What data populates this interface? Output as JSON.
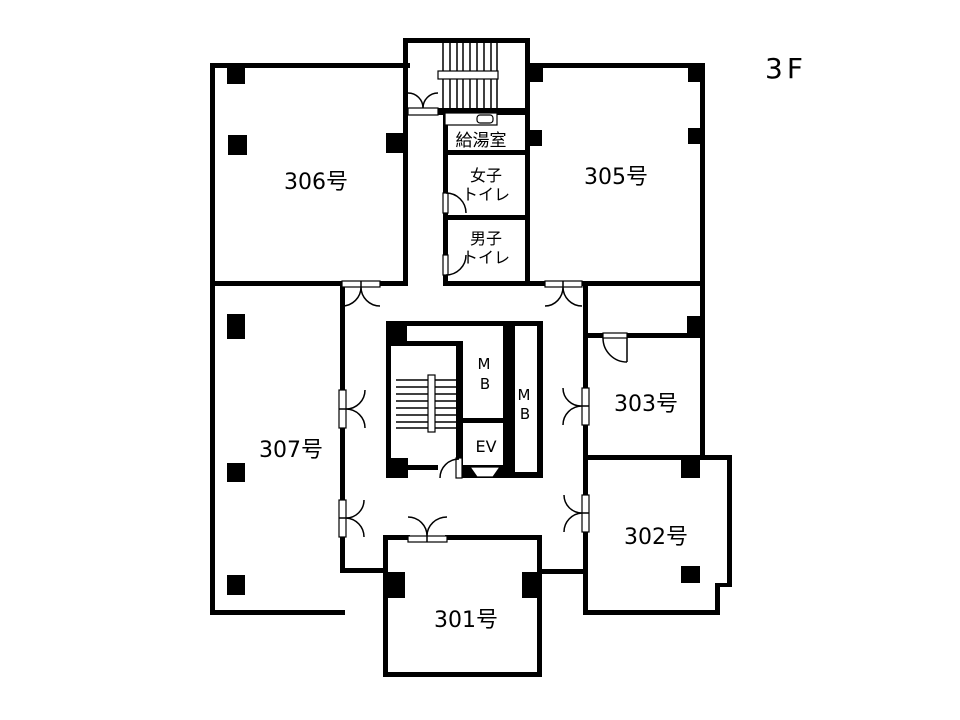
{
  "page": {
    "floor_label": "3F"
  },
  "rooms": {
    "r306": "306号",
    "r305": "305号",
    "r307": "307号",
    "r303": "303号",
    "r302": "302号",
    "r301": "301号"
  },
  "utilities": {
    "kitchenette": "給湯室",
    "womens_toilet_line1": "女子",
    "womens_toilet_line2": "トイレ",
    "mens_toilet_line1": "男子",
    "mens_toilet_line2": "トイレ",
    "meter_box_top_line1": "M",
    "meter_box_top_line2": "B",
    "meter_box_right_line1": "M",
    "meter_box_right_line2": "B",
    "elevator": "EV"
  },
  "colors": {
    "wall": "#000000",
    "background": "#ffffff",
    "text": "#000000"
  }
}
